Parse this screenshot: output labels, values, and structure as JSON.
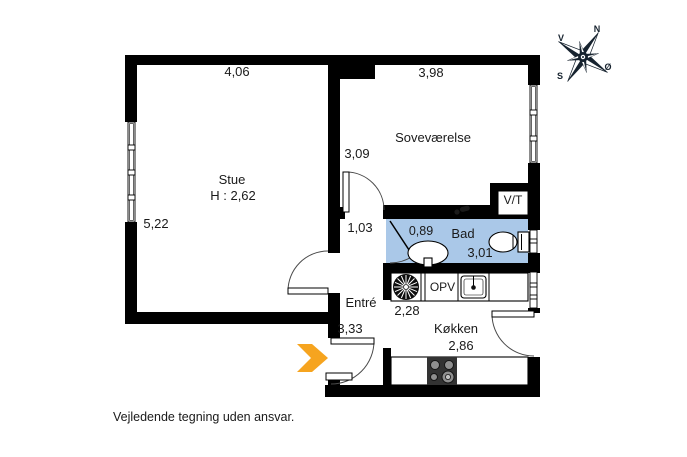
{
  "floorplan": {
    "rooms": {
      "stue": {
        "name": "Stue",
        "ceiling_height": "H : 2,62",
        "width_m": "4,06",
        "depth_m": "5,22"
      },
      "sovevaerelse": {
        "name": "Soveværelse",
        "width_m": "3,98",
        "depth_m": "3,09"
      },
      "bad": {
        "name": "Bad",
        "length_m": "3,01",
        "width_m": "0,89"
      },
      "vt_closet": {
        "name": "V/T"
      },
      "entre": {
        "name": "Entré",
        "length_m": "3,33",
        "hall_width_m": "1,03"
      },
      "kokken": {
        "name": "Køkken",
        "width_m": "2,86",
        "depth_m": "2,28"
      }
    },
    "fixtures": {
      "opv_label": "OPV"
    },
    "compass": {
      "n": "N",
      "e": "Ø",
      "s": "S",
      "v": "V"
    },
    "disclaimer": "Vejledende tegning uden ansvar.",
    "colors": {
      "wall": "#000000",
      "bathroom_fill": "#aac8e8",
      "entry_arrow": "#f6a41f",
      "compass_ink": "#16222e"
    }
  }
}
